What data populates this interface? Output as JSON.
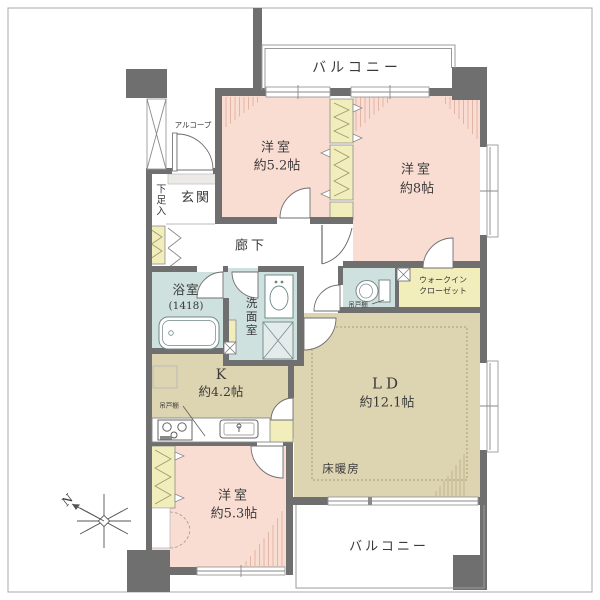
{
  "plan": {
    "balconies": {
      "top": "バルコニー",
      "bottom": "バルコニー"
    },
    "rooms": {
      "bedroom_52": {
        "name": "洋室",
        "size": "約5.2帖"
      },
      "bedroom_8": {
        "name": "洋室",
        "size": "約8帖"
      },
      "bedroom_53": {
        "name": "洋室",
        "size": "約5.3帖"
      },
      "living_dining": {
        "name": "LD",
        "size": "約12.1帖"
      },
      "kitchen": {
        "name": "K",
        "size": "約4.2帖"
      },
      "bathroom": {
        "name": "浴室",
        "size": "(1418)"
      },
      "washroom": {
        "name": "洗面室"
      },
      "entrance": {
        "name": "玄関"
      },
      "corridor": {
        "name": "廊下"
      },
      "shoe_storage": {
        "name": "下足入"
      },
      "alcove": {
        "name": "アルコープ"
      },
      "walk_in_closet": {
        "line1": "ウォークイン",
        "line2": "クローゼット"
      },
      "floor_heating": {
        "name": "床暖房"
      }
    },
    "fixtures": {
      "hanging_cupboard_toilet": "吊戸棚",
      "hanging_cupboard_kitchen": "吊戸棚"
    },
    "compass": {
      "north_label": "N"
    },
    "colors": {
      "wall": "#6f6f6f",
      "room_pink": "#f9ddd3",
      "room_beige": "#ddd4b2",
      "wet_area_blue": "#cfe1df",
      "closet_yellow": "#f2eebb",
      "outline_gray": "#999999",
      "text": "#3a3a3a"
    }
  }
}
